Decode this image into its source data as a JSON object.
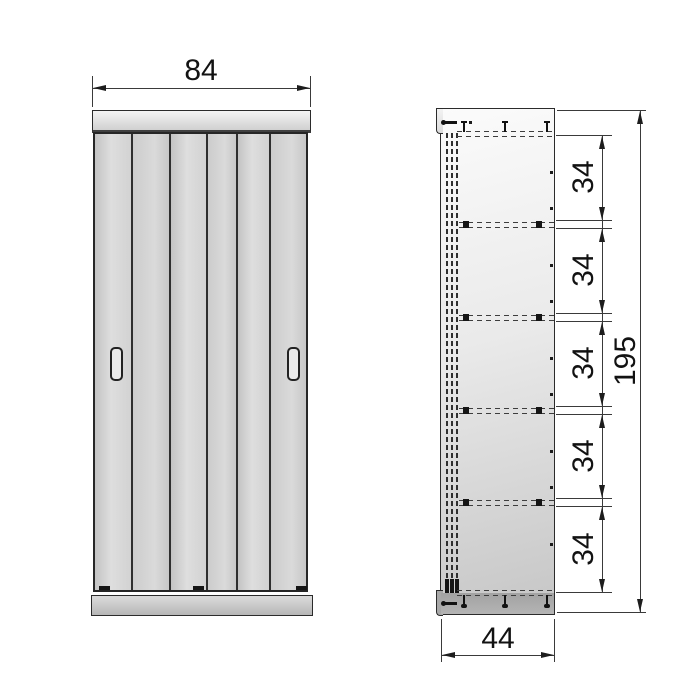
{
  "diagram": {
    "name": "wardrobe-dimension-drawing",
    "front": {
      "width_label": "84"
    },
    "side": {
      "height_label": "195",
      "depth_label": "44",
      "spacings": [
        "34",
        "34",
        "34",
        "34",
        "34"
      ]
    },
    "colors": {
      "outline": "#2b2b2b",
      "panel_light": "#eaeaea",
      "panel_dark": "#b4b4b4"
    }
  }
}
